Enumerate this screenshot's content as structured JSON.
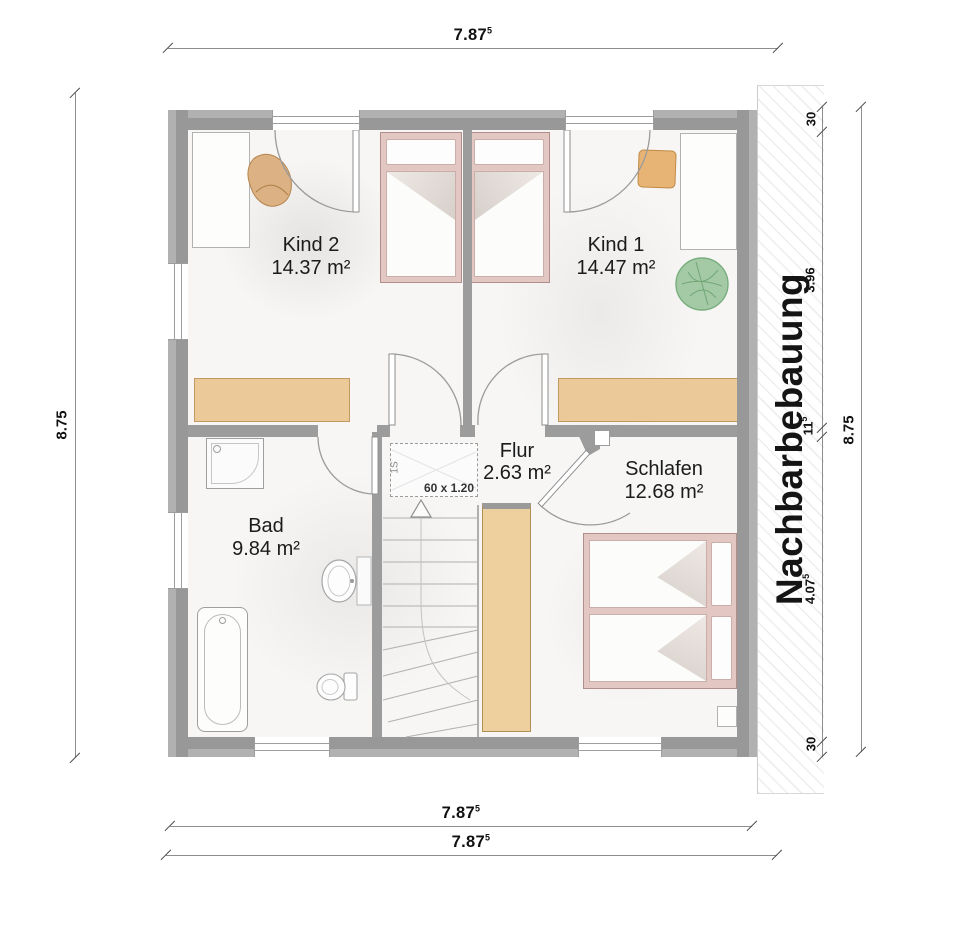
{
  "plan": {
    "rooms": [
      {
        "name": "Kind 2",
        "area": "14.37 m²"
      },
      {
        "name": "Kind 1",
        "area": "14.47 m²"
      },
      {
        "name": "Flur",
        "area": "2.63 m²"
      },
      {
        "name": "Schlafen",
        "area": "12.68 m²"
      },
      {
        "name": "Bad",
        "area": "9.84 m²"
      }
    ],
    "neighbor_label": "Nachbarbebauung",
    "skylight": {
      "size_label": "60 x 1.20",
      "id_label": "1S"
    }
  },
  "dimensions": {
    "top": {
      "value": "7.87",
      "sup": "5"
    },
    "bottom_inner": {
      "value": "7.87",
      "sup": "5"
    },
    "bottom_outer": {
      "value": "7.87",
      "sup": "5"
    },
    "left": {
      "value": "8.75",
      "sup": ""
    },
    "right_outer": {
      "value": "8.75",
      "sup": ""
    },
    "right_inner_segments": [
      {
        "value": "30",
        "sup": ""
      },
      {
        "value": "3.96",
        "sup": ""
      },
      {
        "value": "11",
        "sup": "5"
      },
      {
        "value": "4.07",
        "sup": "5"
      },
      {
        "value": "30",
        "sup": ""
      }
    ]
  },
  "colors": {
    "wall": "#9c9c9c",
    "floor": "#f7f6f5",
    "wood_furniture": "#ecc998",
    "bed_frame": "#e2c7c3",
    "plant_green": "#9dc79f",
    "dim_text": "#111111"
  }
}
